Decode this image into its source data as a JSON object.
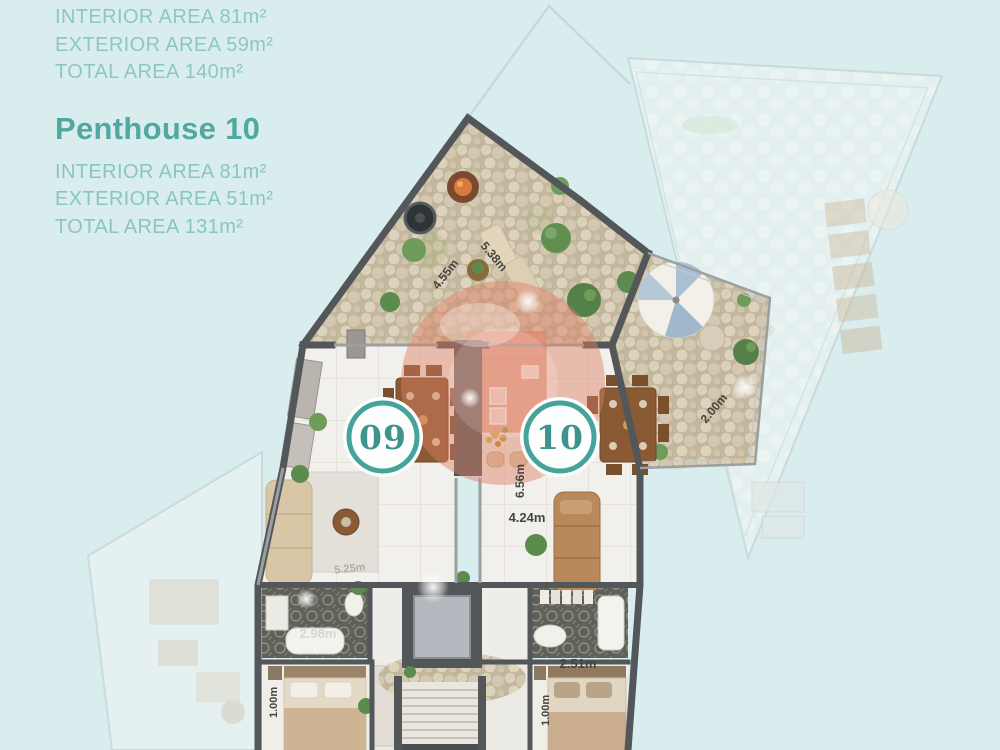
{
  "info_panel": {
    "unit_a": {
      "interior": "INTERIOR AREA 81m²",
      "exterior": "EXTERIOR AREA 59m²",
      "total": "TOTAL AREA 140m²"
    },
    "unit_b": {
      "title": "Penthouse 10",
      "interior": "INTERIOR AREA 81m²",
      "exterior": "EXTERIOR AREA 51m²",
      "total": "TOTAL AREA 131m²"
    }
  },
  "plan": {
    "unit_badges": [
      {
        "number": "09"
      },
      {
        "number": "10"
      }
    ],
    "dimension_labels": [
      {
        "text": "4.55m"
      },
      {
        "text": "5.38m"
      },
      {
        "text": "2.00m"
      },
      {
        "text": "6.56m"
      },
      {
        "text": "4.24m"
      },
      {
        "text": "5.25m"
      },
      {
        "text": "2.98m"
      },
      {
        "text": "2.51m"
      },
      {
        "text": "1.00m"
      },
      {
        "text": "1.00m"
      }
    ],
    "colors": {
      "background": "#d9edee",
      "accent_teal": "#46a39a",
      "info_text_teal": "#8dc7c2",
      "title_teal": "#51a8a0",
      "highlight_salmon": "#dd7f63",
      "wall_gray": "#54575a",
      "terrace_stone": "#d7cbb4"
    }
  }
}
